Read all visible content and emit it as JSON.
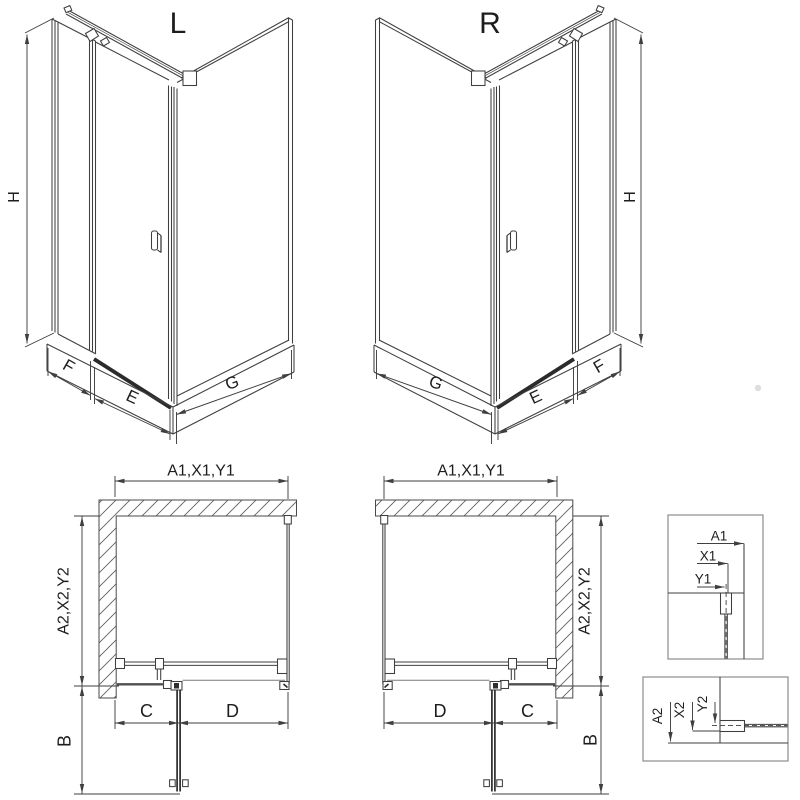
{
  "drawing": {
    "iso_left": {
      "title": "L",
      "height": "H",
      "fixed": "F",
      "door": "E",
      "side": "G"
    },
    "iso_right": {
      "title": "R",
      "height": "H",
      "fixed": "F",
      "door": "E",
      "side": "G"
    },
    "plan_left": {
      "width": "A1,X1,Y1",
      "depth": "A2,X2,Y2",
      "fixed": "C",
      "door": "D",
      "swing": "B"
    },
    "plan_right": {
      "width": "A1,X1,Y1",
      "depth": "A2,X2,Y2",
      "fixed": "C",
      "door": "D",
      "swing": "B"
    },
    "detail_width": {
      "a": "A1",
      "x": "X1",
      "y": "Y1"
    },
    "detail_depth": {
      "a": "A2",
      "x": "X2",
      "y": "Y2"
    },
    "colors": {
      "line": "#3f3f3f",
      "dark": "#2b2b2b",
      "muted": "#7a7a7a",
      "box_border": "#8c8c8c",
      "hatch": "#5f5f5f",
      "text": "#1d1d1d",
      "background": "#ffffff"
    }
  }
}
